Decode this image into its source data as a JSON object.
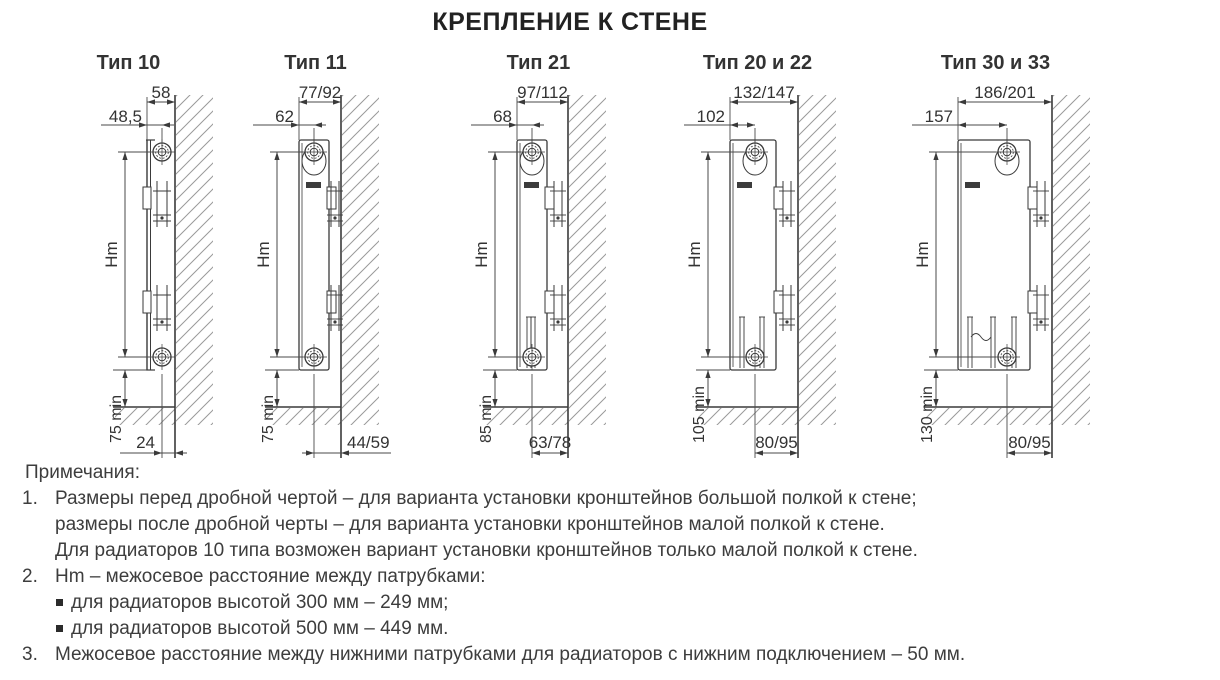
{
  "title": "КРЕПЛЕНИЕ К СТЕНЕ",
  "diagrams": [
    {
      "id": "tip-10",
      "title": "Тип 10",
      "dim_depth": "58",
      "dim_axis": "48,5",
      "dim_height": "Hm",
      "dim_floor": "75 min",
      "dim_bottom": "24"
    },
    {
      "id": "tip-11",
      "title": "Тип 11",
      "dim_depth": "77/92",
      "dim_axis": "62",
      "dim_height": "Hm",
      "dim_floor": "75 min",
      "dim_bottom": "44/59"
    },
    {
      "id": "tip-21",
      "title": "Тип 21",
      "dim_depth": "97/112",
      "dim_axis": "68",
      "dim_height": "Hm",
      "dim_floor": "85 min",
      "dim_bottom": "63/78"
    },
    {
      "id": "tip-20-22",
      "title": "Тип 20 и 22",
      "dim_depth": "132/147",
      "dim_axis": "102",
      "dim_height": "Hm",
      "dim_floor": "105 min",
      "dim_bottom": "80/95"
    },
    {
      "id": "tip-30-33",
      "title": "Тип 30 и 33",
      "dim_depth": "186/201",
      "dim_axis": "157",
      "dim_height": "Hm",
      "dim_floor": "130 min",
      "dim_bottom": "80/95"
    }
  ],
  "notes": {
    "heading": "Примечания:",
    "items": [
      {
        "num": "1.",
        "lines": [
          "Размеры перед дробной чертой – для варианта установки кронштейнов большой полкой к стене;",
          "размеры после дробной черты – для варианта установки кронштейнов малой полкой к стене.",
          "Для радиаторов 10 типа возможен вариант установки кронштейнов только малой полкой к стене."
        ]
      },
      {
        "num": "2.",
        "lines": [
          "Hm – межосевое расстояние между патрубками:"
        ],
        "bullets": [
          "для радиаторов высотой 300 мм – 249 мм;",
          "для радиаторов высотой 500 мм – 449 мм."
        ]
      },
      {
        "num": "3.",
        "lines": [
          "Межосевое расстояние между нижними патрубками для радиаторов с нижним подключением – 50 мм."
        ]
      }
    ]
  },
  "colors": {
    "line": "#3a3a3a",
    "dim": "#4a4a4a",
    "hatch": "#9a9a9a",
    "text": "#333333"
  }
}
